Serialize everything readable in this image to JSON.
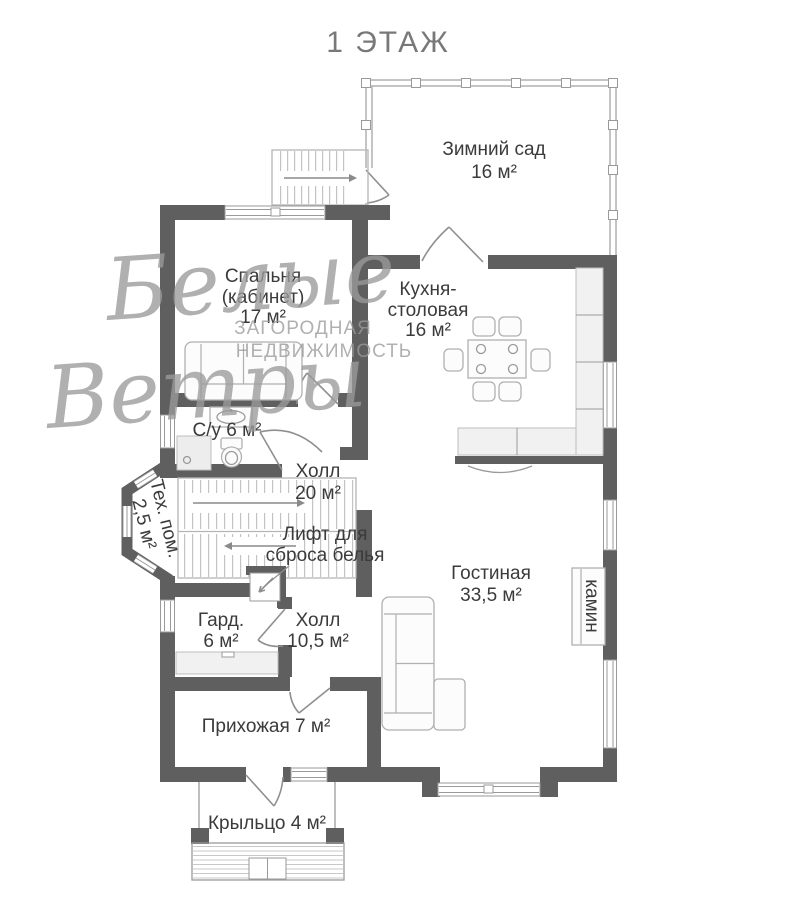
{
  "page_title": "1 ЭТАЖ",
  "watermark": {
    "script_line1": "Белые",
    "script_line2": "Ветры",
    "caps_line1": "ЗАГОРОДНАЯ",
    "caps_line2": "НЕДВИЖИМОСТЬ"
  },
  "rooms": {
    "winter_garden": {
      "name": "Зимний сад",
      "area": "16 м²"
    },
    "bedroom": {
      "line1": "Спальня",
      "line2": "(кабинет)",
      "area": "17 м²"
    },
    "kitchen_dining": {
      "line1": "Кухня-",
      "line2": "столовая",
      "area": "16 м²"
    },
    "bathroom": {
      "label": "С/у 6 м²"
    },
    "hall_main": {
      "name": "Холл",
      "area": "20 м²"
    },
    "tech_room": {
      "name": "Тех. пом.",
      "area": "2,5 м²"
    },
    "living_room": {
      "name": "Гостиная",
      "area": "33,5 м²"
    },
    "wardrobe": {
      "name": "Гард.",
      "area": "6 м²"
    },
    "hall_entry": {
      "name": "Холл",
      "area": "10,5 м²"
    },
    "entrance": {
      "label": "Прихожая 7 м²"
    },
    "porch": {
      "label": "Крыльцо 4 м²"
    }
  },
  "features": {
    "laundry_chute": {
      "line1": "Лифт для",
      "line2": "сброса белья"
    },
    "fireplace": {
      "label": "камин"
    }
  },
  "colors": {
    "wall": "#5f5f5f",
    "label_text": "#3b3b3b",
    "title_text": "#787878",
    "watermark": "#9b9b9b",
    "furniture_stroke": "#b0b0b0",
    "background": "#ffffff"
  }
}
